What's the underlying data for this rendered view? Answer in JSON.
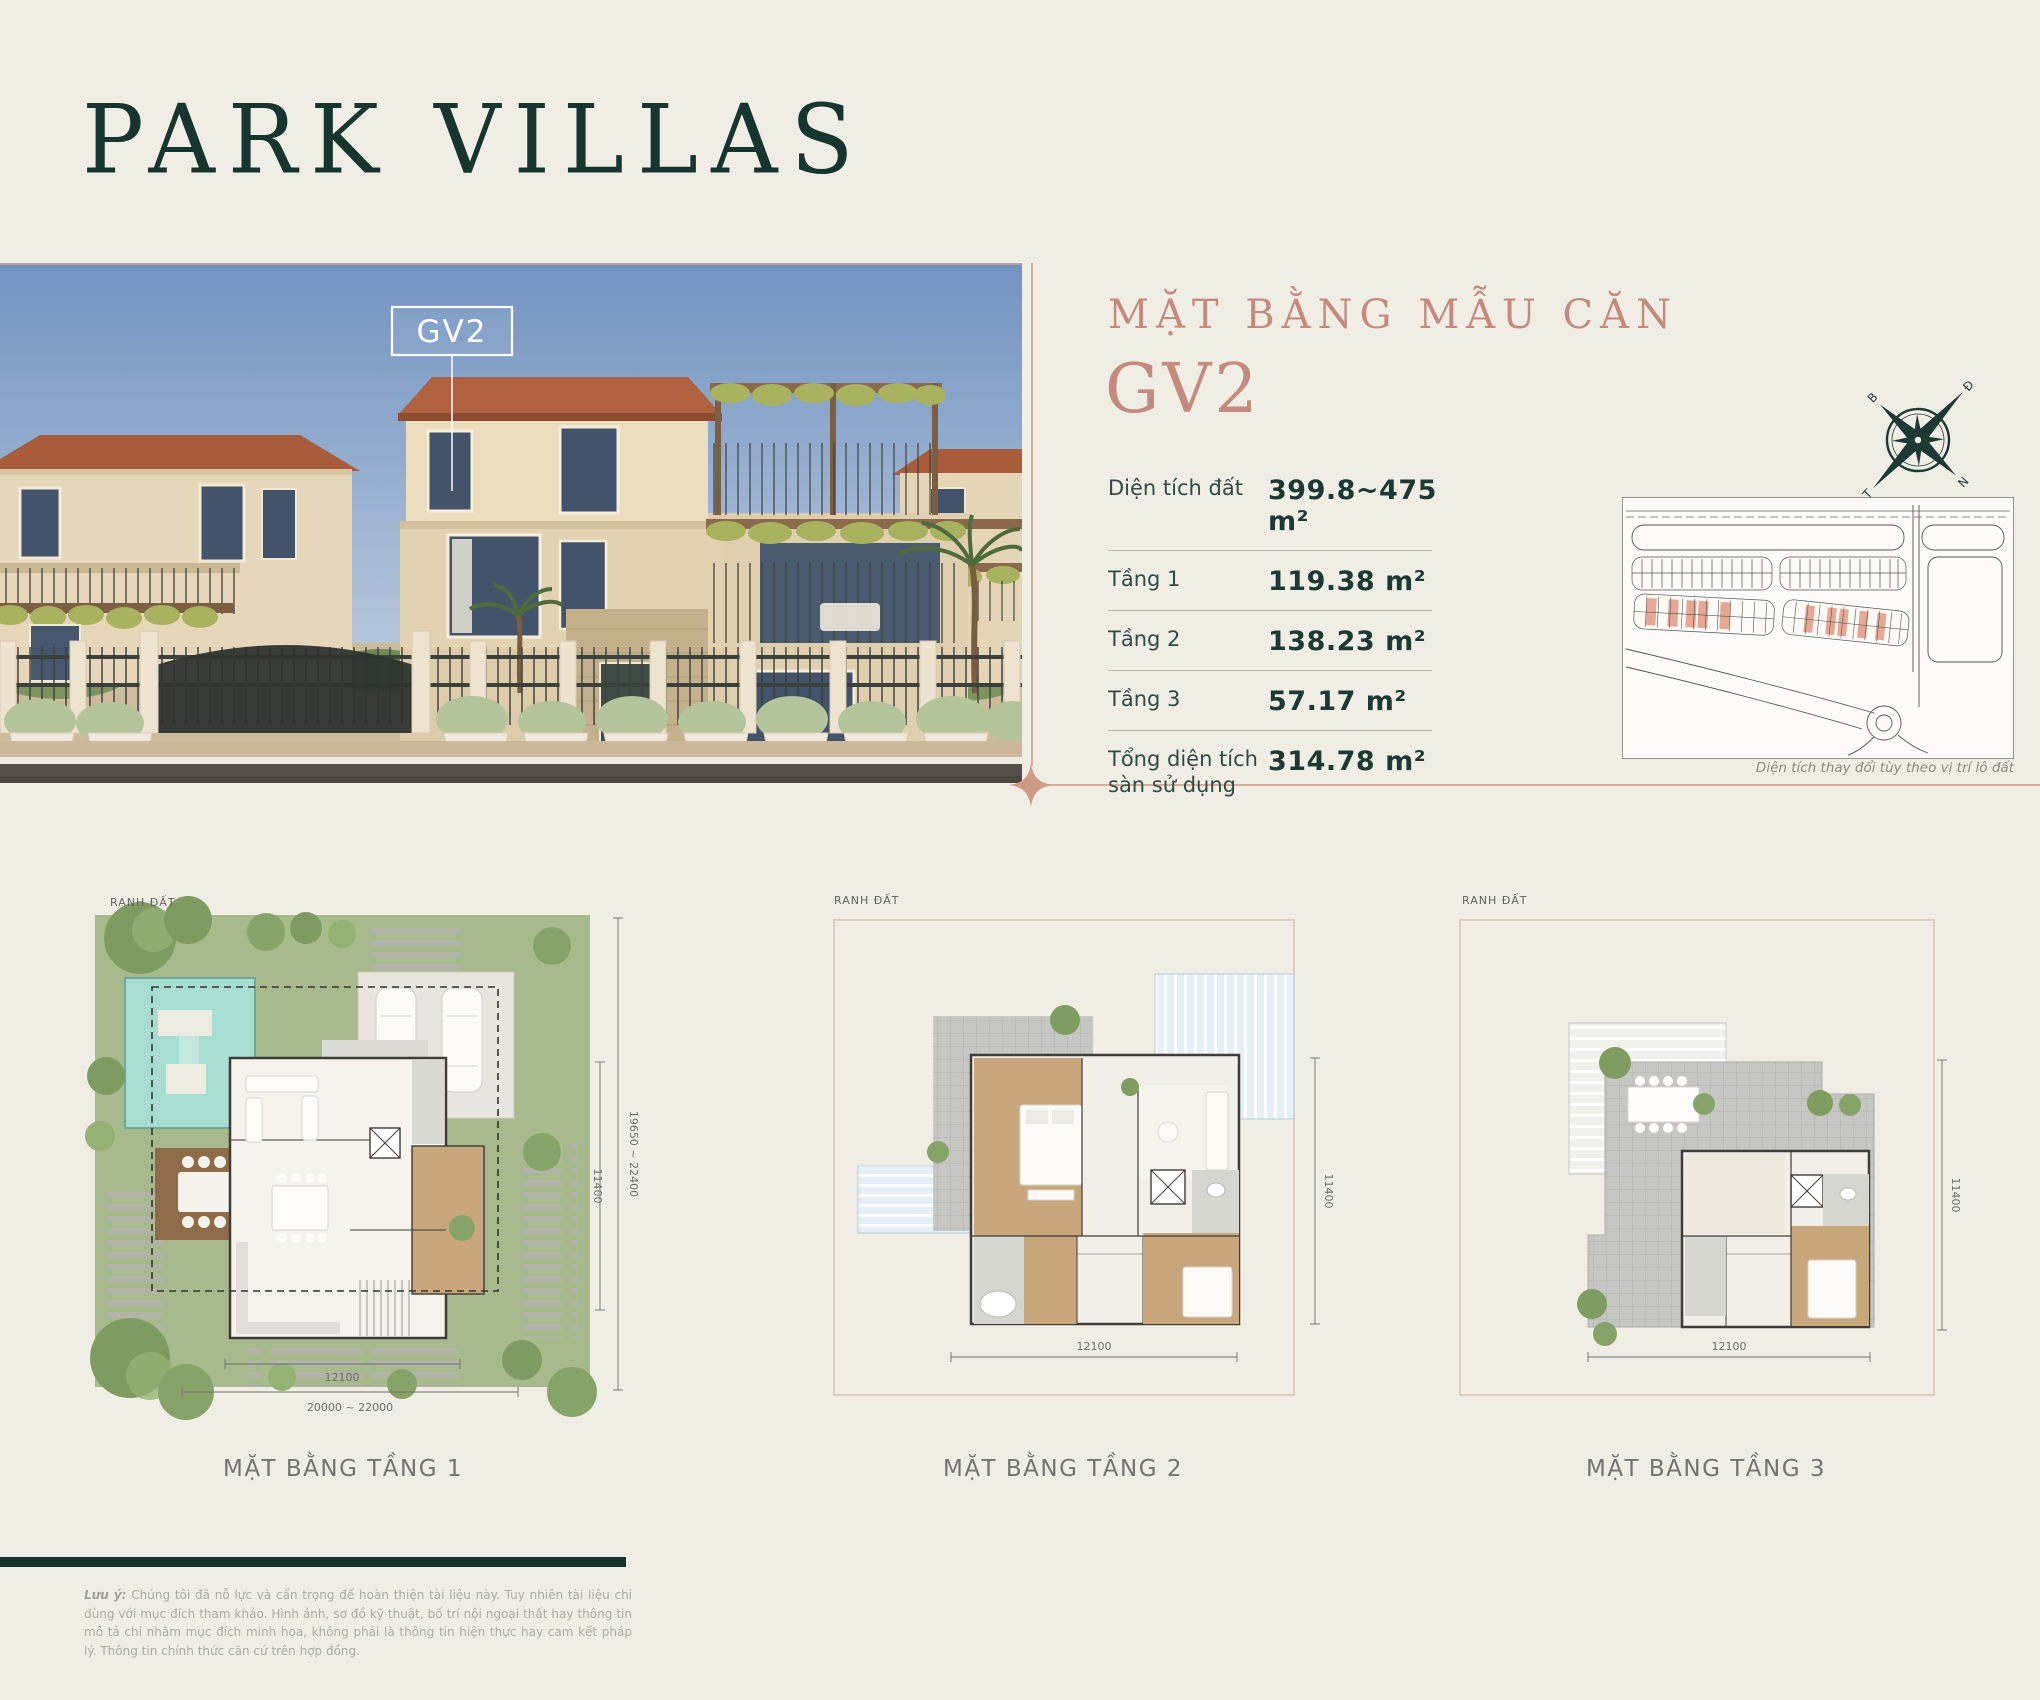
{
  "page": {
    "title": "PARK VILLAS",
    "background": "#f0ede5",
    "accent_teal": "#1b3a33",
    "accent_rose": "#c28b7d",
    "divider_rose": "#d9ab99"
  },
  "photo": {
    "unit_label": "GV2"
  },
  "panel": {
    "heading_small": "MẶT BẰNG MẪU CĂN",
    "heading_large": "GV2",
    "specs": [
      {
        "label": "Diện tích đất",
        "value": "399.8~475 m²"
      },
      {
        "label": "Tầng 1",
        "value": "119.38 m²"
      },
      {
        "label": "Tầng 2",
        "value": "138.23 m²"
      },
      {
        "label": "Tầng 3",
        "value": "57.17 m²"
      },
      {
        "label": "Tổng diện tích sàn sử dụng",
        "value": "314.78 m²"
      }
    ],
    "compass": {
      "north": "B",
      "east": "Đ",
      "south": "N",
      "west": "T"
    },
    "sitemap_caption": "Diện tích thay đổi tùy theo vị trí lô đất"
  },
  "floorplans": [
    {
      "label": "MẶT BẰNG TẦNG 1",
      "boundary": "RANH ĐẤT",
      "dim_house_width": "12100",
      "dim_lot_width": "20000 ~ 22000",
      "dim_lot_depth": "19650 ~ 22400",
      "dim_house_depth": "11400"
    },
    {
      "label": "MẶT BẰNG TẦNG 2",
      "boundary": "RANH ĐẤT",
      "dim_width": "12100",
      "dim_height": "11400"
    },
    {
      "label": "MẶT BẰNG TẦNG 3",
      "boundary": "RANH ĐẤT",
      "dim_width": "12100",
      "dim_height": "11400"
    }
  ],
  "footer": {
    "note_label": "Lưu ý:",
    "note_text": "Chúng tôi đã nỗ lực và cẩn trọng để hoàn thiện tài liệu này. Tuy nhiên tài liệu chỉ dùng với mục đích tham khảo. Hình ảnh, sơ đồ kỹ thuật, bố trí nội ngoại thất hay thông tin mô tả chỉ nhằm mục đích minh họa, không phải là thông tin hiện thực hay cam kết pháp lý. Thông tin chính thức căn cứ trên hợp đồng."
  }
}
